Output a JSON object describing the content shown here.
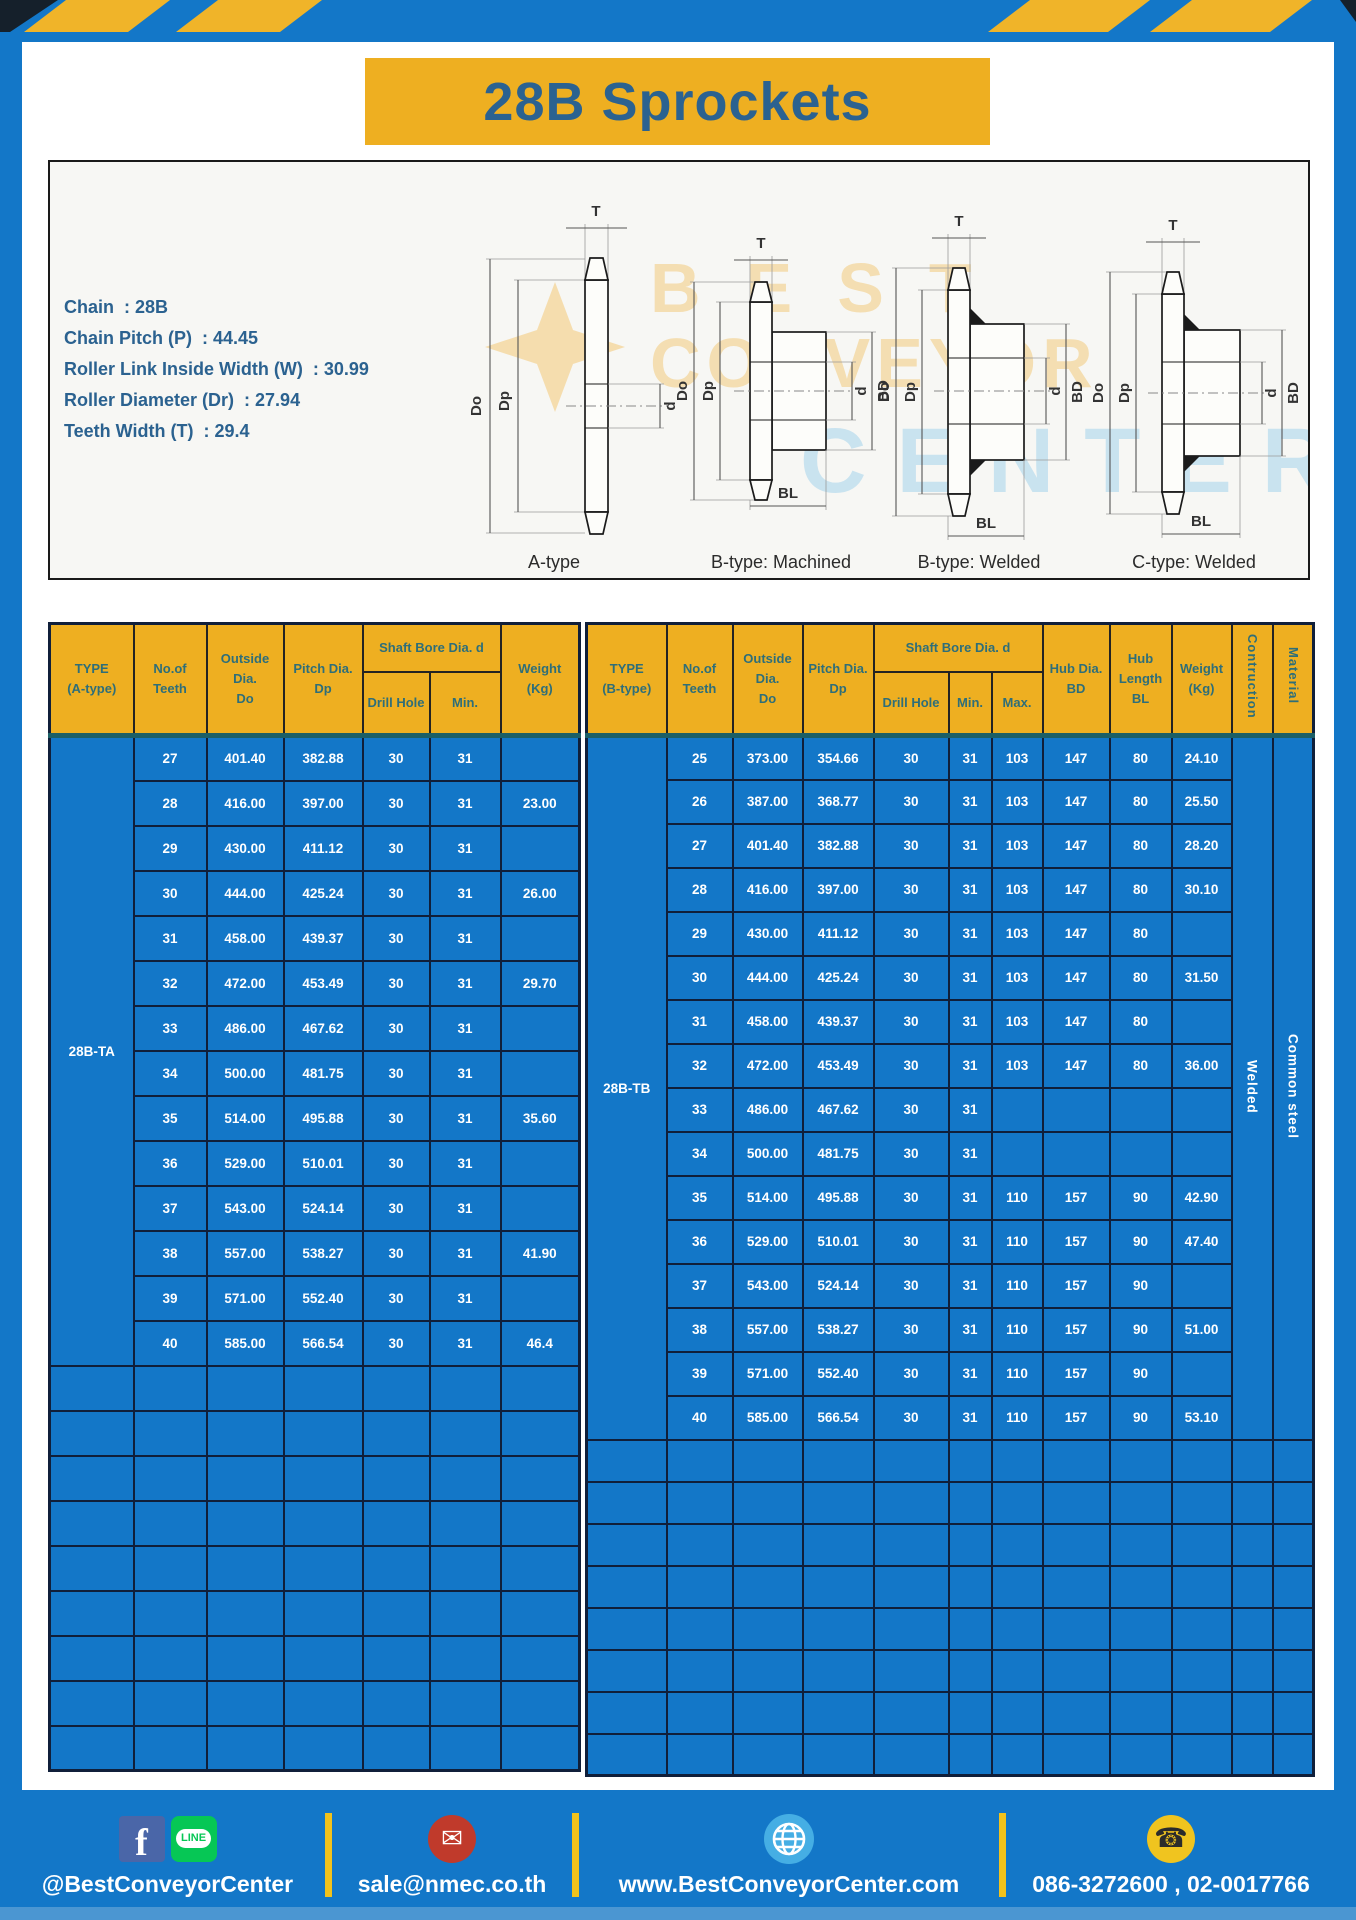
{
  "title": "28B Sprockets",
  "specs": [
    "Chain  : 28B",
    "Chain Pitch (P)  : 44.45",
    "Roller Link Inside Width (W)  : 30.99",
    "Roller Diameter (Dr)  : 27.94",
    "Teeth Width (T)  : 29.4"
  ],
  "diagram": {
    "type_labels": [
      "A-type",
      "B-type: Machined",
      "B-type: Welded",
      "C-type: Welded"
    ],
    "dims": {
      "t": "T",
      "do": "Do",
      "dp": "Dp",
      "d": "d",
      "bd": "BD",
      "bl": "BL"
    },
    "watermark": [
      "BEST",
      "CONVEYOR",
      "CENTER"
    ]
  },
  "tables": {
    "left": {
      "type_col": "TYPE\n(A-type)",
      "teeth_col": "No.of\nTeeth",
      "outside_col": "Outside\nDia.\nDo",
      "pitch_col": "Pitch Dia.\nDp",
      "shaft_col": "Shaft Bore Dia. d",
      "drill_col": "Drill Hole",
      "min_col": "Min.",
      "weight_col": "Weight\n(Kg)",
      "type_value": "28B-TA",
      "rows": [
        [
          "27",
          "401.40",
          "382.88",
          "30",
          "31",
          ""
        ],
        [
          "28",
          "416.00",
          "397.00",
          "30",
          "31",
          "23.00"
        ],
        [
          "29",
          "430.00",
          "411.12",
          "30",
          "31",
          ""
        ],
        [
          "30",
          "444.00",
          "425.24",
          "30",
          "31",
          "26.00"
        ],
        [
          "31",
          "458.00",
          "439.37",
          "30",
          "31",
          ""
        ],
        [
          "32",
          "472.00",
          "453.49",
          "30",
          "31",
          "29.70"
        ],
        [
          "33",
          "486.00",
          "467.62",
          "30",
          "31",
          ""
        ],
        [
          "34",
          "500.00",
          "481.75",
          "30",
          "31",
          ""
        ],
        [
          "35",
          "514.00",
          "495.88",
          "30",
          "31",
          "35.60"
        ],
        [
          "36",
          "529.00",
          "510.01",
          "30",
          "31",
          ""
        ],
        [
          "37",
          "543.00",
          "524.14",
          "30",
          "31",
          ""
        ],
        [
          "38",
          "557.00",
          "538.27",
          "30",
          "31",
          "41.90"
        ],
        [
          "39",
          "571.00",
          "552.40",
          "30",
          "31",
          ""
        ],
        [
          "40",
          "585.00",
          "566.54",
          "30",
          "31",
          "46.4"
        ]
      ],
      "empty_rows": 9
    },
    "right": {
      "type_col": "TYPE\n(B-type)",
      "teeth_col": "No.of\nTeeth",
      "outside_col": "Outside\nDia.\nDo",
      "pitch_col": "Pitch Dia.\nDp",
      "shaft_col": "Shaft Bore Dia. d",
      "drill_col": "Drill Hole",
      "min_col": "Min.",
      "max_col": "Max.",
      "hub_dia_col": "Hub Dia.\nBD",
      "hub_len_col": "Hub\nLength\nBL",
      "weight_col": "Weight\n(Kg)",
      "construction_col": "Contruction",
      "material_col": "Material",
      "type_value": "28B-TB",
      "construction_value": "Welded",
      "material_value": "Common steel",
      "rows": [
        [
          "25",
          "373.00",
          "354.66",
          "30",
          "31",
          "103",
          "147",
          "80",
          "24.10"
        ],
        [
          "26",
          "387.00",
          "368.77",
          "30",
          "31",
          "103",
          "147",
          "80",
          "25.50"
        ],
        [
          "27",
          "401.40",
          "382.88",
          "30",
          "31",
          "103",
          "147",
          "80",
          "28.20"
        ],
        [
          "28",
          "416.00",
          "397.00",
          "30",
          "31",
          "103",
          "147",
          "80",
          "30.10"
        ],
        [
          "29",
          "430.00",
          "411.12",
          "30",
          "31",
          "103",
          "147",
          "80",
          ""
        ],
        [
          "30",
          "444.00",
          "425.24",
          "30",
          "31",
          "103",
          "147",
          "80",
          "31.50"
        ],
        [
          "31",
          "458.00",
          "439.37",
          "30",
          "31",
          "103",
          "147",
          "80",
          ""
        ],
        [
          "32",
          "472.00",
          "453.49",
          "30",
          "31",
          "103",
          "147",
          "80",
          "36.00"
        ],
        [
          "33",
          "486.00",
          "467.62",
          "30",
          "31",
          "",
          "",
          "",
          ""
        ],
        [
          "34",
          "500.00",
          "481.75",
          "30",
          "31",
          "",
          "",
          "",
          ""
        ],
        [
          "35",
          "514.00",
          "495.88",
          "30",
          "31",
          "110",
          "157",
          "90",
          "42.90"
        ],
        [
          "36",
          "529.00",
          "510.01",
          "30",
          "31",
          "110",
          "157",
          "90",
          "47.40"
        ],
        [
          "37",
          "543.00",
          "524.14",
          "30",
          "31",
          "110",
          "157",
          "90",
          ""
        ],
        [
          "38",
          "557.00",
          "538.27",
          "30",
          "31",
          "110",
          "157",
          "90",
          "51.00"
        ],
        [
          "39",
          "571.00",
          "552.40",
          "30",
          "31",
          "110",
          "157",
          "90",
          ""
        ],
        [
          "40",
          "585.00",
          "566.54",
          "30",
          "31",
          "110",
          "157",
          "90",
          "53.10"
        ]
      ],
      "empty_rows": 8
    }
  },
  "footer": {
    "handle": "@BestConveyorCenter",
    "email": "sale@nmec.co.th",
    "website": "www.BestConveyorCenter.com",
    "phones": "086-3272600 , 02-0017766",
    "line_label": "LINE",
    "facebook_glyph": "f",
    "email_glyph": "✉",
    "phone_glyph": "☎"
  },
  "colors": {
    "band_blue": "#1377C8",
    "accent_yellow": "#EEAF21",
    "title_text": "#2B6290",
    "header_text": "#2E6E79",
    "grid_line": "#101F3A",
    "separator_teal": "#1C5F66"
  }
}
